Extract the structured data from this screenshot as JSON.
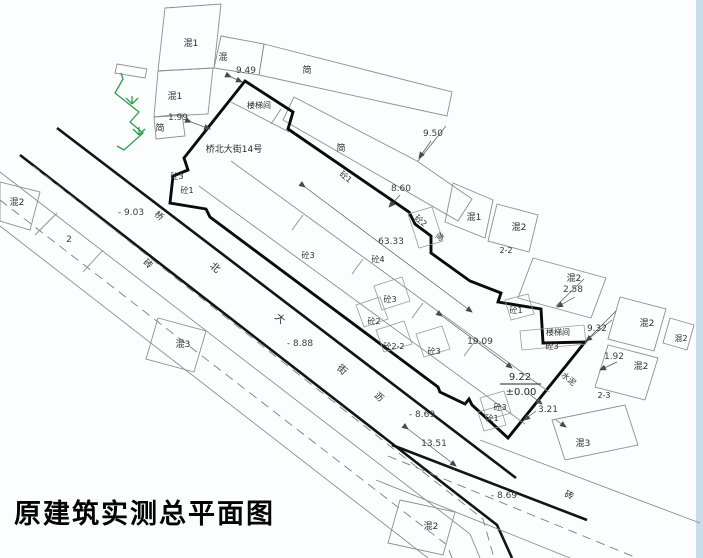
{
  "title": "原建筑实测总平面图",
  "colors": {
    "landscape_green": "#2e9e4f",
    "scan_edge_blue": "#c8ddec",
    "outline_black": "#0b0b0b",
    "thin_line_gray": "#8e8e8e"
  },
  "labels": {
    "title": "原建筑实测总平面图",
    "addr": "桥北大街14号",
    "stair1": "楼梯间",
    "stair2": "楼梯间",
    "hun1_a": "混1",
    "hun1_b": "混1",
    "hun1_c": "混1",
    "hun_a": "混",
    "jian_a": "简",
    "jian_b": "简",
    "jian_c": "简",
    "jian_d": "简",
    "hun2_a": "混2",
    "hun2_b": "混2",
    "hun2_c": "混2",
    "hun2_d": "混2",
    "hun2_e": "混2",
    "hun2_f": "混2",
    "hun2_g": "混2",
    "hun3_a": "混3",
    "hun3_b": "混3",
    "zhuan_a": "砖",
    "zhuan_b": "砖",
    "shuini": "水泥",
    "li": "沥",
    "qiao": "桥",
    "bei": "北",
    "da": "大",
    "jie": "街",
    "tong1_a": "砼1",
    "tong1_b": "砼1",
    "tong1_c": "砼1",
    "tong1_d": "砼1",
    "tong2_a": "砼2",
    "tong2_b": "砼2",
    "tong22": "砼2-2",
    "tong3_a": "砼3",
    "tong3_b": "砼3",
    "tong3_c": "砼3",
    "tong3_d": "砼3",
    "tong3_e": "砼3",
    "tong3_f": "砼3",
    "tong4": "砼4",
    "d949": "9.49",
    "d950": "9.50",
    "d860": "8.60",
    "d199": "1.99",
    "d6333": "63.33",
    "d1909": "19.09",
    "d922": "9.22",
    "dpm000": "±0.00",
    "d258": "2.58",
    "d932": "9.32",
    "d192": "1.92",
    "d321": "3.21",
    "d1351": "13.51",
    "d22": "2-2",
    "d23": "2-3",
    "d2": "2",
    "e903": "- 9.03",
    "e888": "- 8.88",
    "e869a": "- 8.69",
    "e869b": "- 8.69"
  }
}
